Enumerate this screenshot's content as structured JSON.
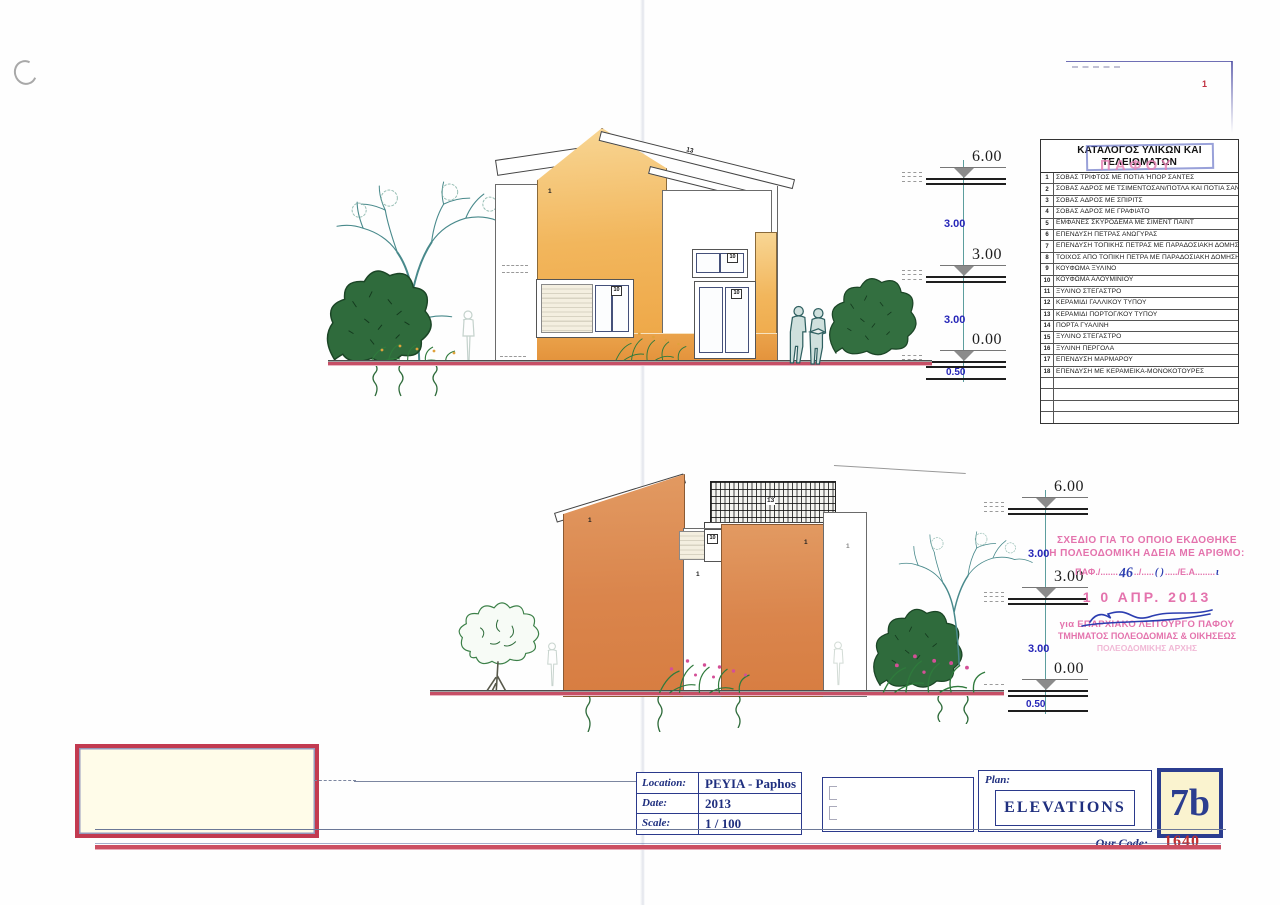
{
  "sheet": {
    "corner_mark": "1",
    "pafou_stamp": "ΠΑΦΟΥ"
  },
  "materials_table": {
    "title": "ΚΑΤΑΛΟΓΟΣ ΥΛΙΚΩΝ ΚΑΙ ΤΕΛΕΙΩΜΑΤΩΝ",
    "rows": [
      {
        "num": "1",
        "text": "ΣΟΒΑΣ ΤΡΙΦΤΟΣ ΜΕ ΠΟΤΙΑ ΉΠΟΡ ΣΑΝΤΕΣ"
      },
      {
        "num": "2",
        "text": "ΣΟΒΑΣ ΑΔΡΟΣ ΜΕ ΤΣΙΜΕΝΤΟΣΑΝ/ΠΟΤΛΑ ΚΑΙ ΠΟΤΙΑ ΣΑΝΤΕΣ"
      },
      {
        "num": "3",
        "text": "ΣΟΒΑΣ ΑΔΡΟΣ ΜΕ ΣΠΙΡΙΤΣ"
      },
      {
        "num": "4",
        "text": "ΣΟΒΑΣ ΑΔΡΟΣ ΜΕ ΓΡΑΦΙΑΤΟ"
      },
      {
        "num": "5",
        "text": "ΕΜΦΑΝΕΣ ΣΚΥΡΟΔΕΜΑ ΜΕ ΣΙΜΕΝΤ ΠΑΙΝΤ"
      },
      {
        "num": "6",
        "text": "ΕΠΕΝΔΥΣΗ ΠΕΤΡΑΣ ΑΝΩΓΥΡΑΣ"
      },
      {
        "num": "7",
        "text": "ΕΠΕΝΔΥΣΗ ΤΟΠΙΚΗΣ ΠΕΤΡΑΣ ΜΕ ΠΑΡΑΔΟΣΙΑΚΗ ΔΟΜΗΣΗ"
      },
      {
        "num": "8",
        "text": "ΤΟΙΧΟΣ ΑΠΟ ΤΟΠΙΚΗ ΠΕΤΡΑ ΜΕ ΠΑΡΑΔΟΣΙΑΚΗ ΔΟΜΗΣΗ"
      },
      {
        "num": "9",
        "text": "ΚΟΥΦΩΜΑ ΞΥΛΙΝΟ"
      },
      {
        "num": "10",
        "text": "ΚΟΥΦΩΜΑ ΑΛΟΥΜΙΝΙΟΥ"
      },
      {
        "num": "11",
        "text": "ΞΥΛΙΝΟ ΣΤΕΓΑΣΤΡΟ"
      },
      {
        "num": "12",
        "text": "ΚΕΡΑΜΙΔΙ ΓΑΛΛΙΚΟΥ ΤΥΠΟΥ"
      },
      {
        "num": "13",
        "text": "ΚΕΡΑΜΙΔΙ ΠΟΡΤΟΓ/ΚΟΥ ΤΥΠΟΥ"
      },
      {
        "num": "14",
        "text": "ΠΟΡΤΑ ΓΥΑΛΙΝΗ"
      },
      {
        "num": "15",
        "text": "ΞΥΛΙΝΟ ΣΤΕΓΑΣΤΡΟ"
      },
      {
        "num": "16",
        "text": "ΞΥΛΙΝΗ ΠΕΡΓΟΛΑ"
      },
      {
        "num": "17",
        "text": "ΕΠΕΝΔΥΣΗ ΜΑΡΜΑΡΟΥ"
      },
      {
        "num": "18",
        "text": "ΕΠΕΝΔΥΣΗ ΜΕ ΚΕΡΑΜΕΙΚΑ-ΜΟΝΟΚΟΤΟΥΡΕΣ"
      }
    ],
    "empty_row_count": 4
  },
  "levels": {
    "top": "6.00",
    "middle": "3.00",
    "ground": "0.00",
    "story": "3.00",
    "base": "0.50"
  },
  "annotations": {
    "wall": "1",
    "opening": "10",
    "roof": "13"
  },
  "approval_stamp": {
    "line1": "ΣΧΕΔΙΟ ΓΙΑ ΤΟ ΟΠΟΙΟ ΕΚΔΟΘΗΚΕ",
    "line2": "Η ΠΟΛΕΟΔΟΜΙΚΗ ΑΔΕΙΑ ΜΕ ΑΡΙΘΜΟ:",
    "ref_p1": "ΠΑΦ./.......",
    "ref_hw1": "46",
    "ref_p2": "../.....",
    "ref_hw2": "( )",
    "ref_p3": "...../Ε.Α........",
    "ref_hw3": "ι",
    "date": "1 0 ΑΠΡ. 2013",
    "for_line1": "για ΕΠΑΡΧΙΑΚΟ ΛΕΙΤΟΥΡΓΟ ΠΑΦΟΥ",
    "for_line2": "ΤΜΗΜΑΤΟΣ ΠΟΛΕΟΔΟΜΙΑΣ & ΟΙΚΗΣΕΩΣ",
    "for_line3": "ΠΟΛΕΟΔΟΜΙΚΗΣ ΑΡΧΗΣ"
  },
  "title_block": {
    "location_label": "Location:",
    "location_value": "PEYIA - Paphos",
    "date_label": "Date:",
    "date_value": "2013",
    "scale_label": "Scale:",
    "scale_value": "1 / 100",
    "plan_label": "Plan:",
    "plan_value": "ELEVATIONS",
    "sheet_number": "7b",
    "our_code_label": "Our Code:",
    "our_code_value": "1640"
  },
  "colors": {
    "wall_orange_top": "#f2b65c",
    "wall_orange_bottom": "#db8550",
    "ground_red": "#c64f66",
    "stamp_pink": "#e473ad",
    "navy": "#1f2f7f",
    "code_red": "#bf3030"
  }
}
